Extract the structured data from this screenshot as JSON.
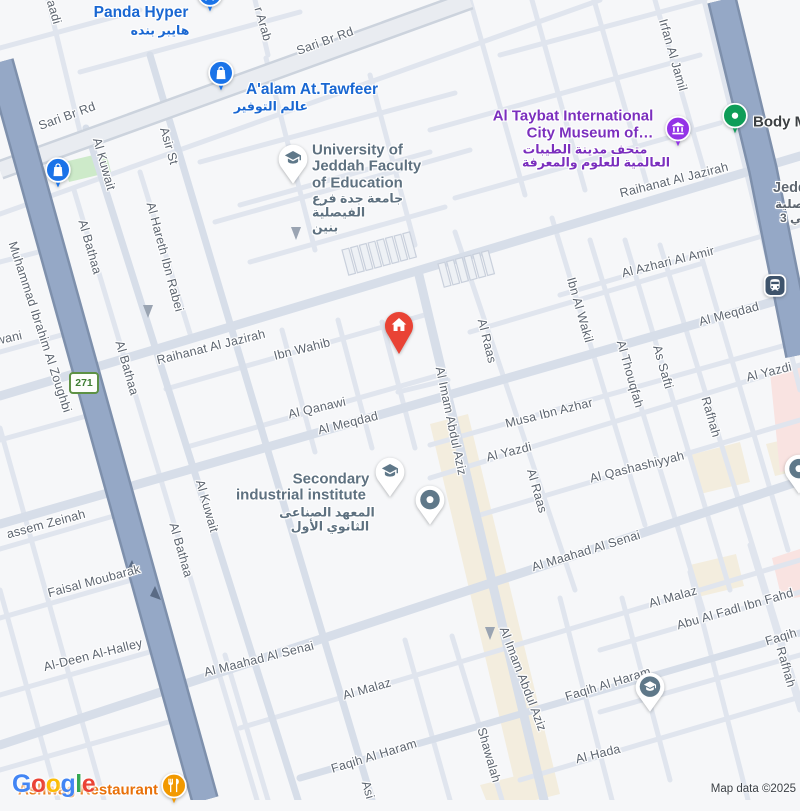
{
  "map_colors": {
    "background": "#f6f7f9",
    "road_minor": "#e0e5ee",
    "road_major": "#d7dee9",
    "sari_fill": "#e9ecf1",
    "sari_casing": "#ccd3dd",
    "highway_fill": "#95a8c6",
    "highway_casing": "#7e90ac",
    "park_green": "#cdeac9",
    "commercial_beige": "#f3edde",
    "hospital_pink": "#f9e3e1",
    "poi_blue": "#1a73e8",
    "poi_blue_text": "#1967d2",
    "poi_purple": "#9334e6",
    "poi_purple_text": "#7b2fbe",
    "poi_green": "#0f9d58",
    "poi_orange": "#f29900",
    "poi_orange_text": "#e8710a",
    "poi_red": "#e94335",
    "poi_slate": "#5f7889",
    "school_text": "#5e7180",
    "transit_navy": "#3e536b"
  },
  "road_labels": [
    {
      "text": "Sari Br Rd",
      "x": 67,
      "y": 116,
      "rot": -20
    },
    {
      "text": "Sari Br Rd",
      "x": 325,
      "y": 41,
      "rot": -20
    },
    {
      "text": "Raihanat Al Jazirah",
      "x": 674,
      "y": 180,
      "rot": -14
    },
    {
      "text": "Raihanat Al Jazirah",
      "x": 211,
      "y": 347,
      "rot": -14
    },
    {
      "text": "Ibn Wahib",
      "x": 302,
      "y": 349,
      "rot": -14
    },
    {
      "text": "Al Qanawi",
      "x": 317,
      "y": 408,
      "rot": -13
    },
    {
      "text": "Al Meqdad",
      "x": 348,
      "y": 423,
      "rot": -14
    },
    {
      "text": "Al Meqdad",
      "x": 729,
      "y": 314,
      "rot": -15
    },
    {
      "text": "Musa Ibn Azhar",
      "x": 549,
      "y": 413,
      "rot": -14
    },
    {
      "text": "Al Yazdi",
      "x": 509,
      "y": 452,
      "rot": -14
    },
    {
      "text": "Al Yazdi",
      "x": 769,
      "y": 372,
      "rot": -14
    },
    {
      "text": "Al Qashashiyyah",
      "x": 637,
      "y": 467,
      "rot": -14
    },
    {
      "text": "Al Azhari Al Amir",
      "x": 668,
      "y": 262,
      "rot": -14
    },
    {
      "text": "Al Maahad Al Senai",
      "x": 586,
      "y": 551,
      "rot": -17
    },
    {
      "text": "Al Maahad Al Senai",
      "x": 259,
      "y": 659,
      "rot": -14
    },
    {
      "text": "Al Malaz",
      "x": 367,
      "y": 689,
      "rot": -16
    },
    {
      "text": "Al Malaz",
      "x": 673,
      "y": 597,
      "rot": -16
    },
    {
      "text": "Faqih Al Haram",
      "x": 374,
      "y": 756,
      "rot": -17
    },
    {
      "text": "Faqih Al Haram",
      "x": 608,
      "y": 684,
      "rot": -17
    },
    {
      "text": "Faqih",
      "x": 781,
      "y": 637,
      "rot": -17
    },
    {
      "text": "Al Hada",
      "x": 598,
      "y": 754,
      "rot": -14
    },
    {
      "text": "Abu Al Fadl Ibn Fahd",
      "x": 735,
      "y": 609,
      "rot": -16
    },
    {
      "text": "Faisal Moubarak",
      "x": 94,
      "y": 581,
      "rot": -15
    },
    {
      "text": "assem Zeinah",
      "x": 46,
      "y": 524,
      "rot": -15
    },
    {
      "text": "Al-Deen Al-Halley",
      "x": 93,
      "y": 655,
      "rot": -14
    },
    {
      "text": "wani",
      "x": 9,
      "y": 338,
      "rot": -13
    },
    {
      "text": "Al Kuwait",
      "x": 104,
      "y": 164,
      "rot": 74
    },
    {
      "text": "Al Kuwait",
      "x": 207,
      "y": 506,
      "rot": 74
    },
    {
      "text": "Asir St",
      "x": 169,
      "y": 146,
      "rot": 74
    },
    {
      "text": "Asi",
      "x": 368,
      "y": 790,
      "rot": 74
    },
    {
      "text": "Al Bathaa",
      "x": 90,
      "y": 247,
      "rot": 74
    },
    {
      "text": "Al Bathaa",
      "x": 127,
      "y": 368,
      "rot": 74
    },
    {
      "text": "Al Bathaa",
      "x": 181,
      "y": 550,
      "rot": 74
    },
    {
      "text": "Al Hareth Ibn Rabei",
      "x": 165,
      "y": 257,
      "rot": 75
    },
    {
      "text": "Muhammad Ibrahim Al Zoughbi",
      "x": 40,
      "y": 327,
      "rot": 72
    },
    {
      "text": "Al Imam Abdul Aziz",
      "x": 451,
      "y": 421,
      "rot": 78
    },
    {
      "text": "Al Imam Abdul Aziz",
      "x": 523,
      "y": 679,
      "rot": 69
    },
    {
      "text": "Al Raas",
      "x": 487,
      "y": 341,
      "rot": 76
    },
    {
      "text": "Al Raas",
      "x": 537,
      "y": 491,
      "rot": 74
    },
    {
      "text": "Ibn Al Wakil",
      "x": 580,
      "y": 310,
      "rot": 74
    },
    {
      "text": "Al Thouqfah",
      "x": 630,
      "y": 374,
      "rot": 74
    },
    {
      "text": "As Safti",
      "x": 663,
      "y": 367,
      "rot": 74
    },
    {
      "text": "Rafhah",
      "x": 711,
      "y": 417,
      "rot": 74
    },
    {
      "text": "Rafhah",
      "x": 786,
      "y": 667,
      "rot": 74
    },
    {
      "text": "Irfan Al Jamil",
      "x": 673,
      "y": 55,
      "rot": 74
    },
    {
      "text": "r Arab",
      "x": 263,
      "y": 24,
      "rot": 74
    },
    {
      "text": "Shawalah",
      "x": 489,
      "y": 755,
      "rot": 74
    },
    {
      "text": "aadi",
      "x": 54,
      "y": 12,
      "rot": 74
    }
  ],
  "poi_labels": [
    {
      "text": "Panda Hyper",
      "x": 141,
      "y": 13,
      "color": "#1967d2",
      "size": 15.5
    },
    {
      "text": "هايبر بنده",
      "x": 160,
      "y": 30,
      "color": "#1967d2",
      "size": 12.5
    },
    {
      "text": "A'alam At.Tawfeer",
      "x": 312,
      "y": 90,
      "color": "#1967d2",
      "size": 15.5
    },
    {
      "text": "عالم التوفير",
      "x": 271,
      "y": 106,
      "color": "#1967d2",
      "size": 12.5
    },
    {
      "text": "University of",
      "x": 312,
      "y": 150,
      "color": "#5e7180",
      "size": 15,
      "align": "l"
    },
    {
      "text": "Jeddah Faculty",
      "x": 312,
      "y": 166,
      "color": "#5e7180",
      "size": 15,
      "align": "l"
    },
    {
      "text": "of Education",
      "x": 312,
      "y": 183,
      "color": "#5e7180",
      "size": 15,
      "align": "l"
    },
    {
      "text": "جامعة جدة فرع",
      "x": 312,
      "y": 198,
      "color": "#5e7180",
      "size": 12.5,
      "align": "l"
    },
    {
      "text": "الفيصلية",
      "x": 312,
      "y": 212,
      "color": "#5e7180",
      "size": 12.5,
      "align": "l"
    },
    {
      "text": "بنين",
      "x": 312,
      "y": 227,
      "color": "#5e7180",
      "size": 12.5,
      "align": "l"
    },
    {
      "text": "Al Taybat International",
      "x": 573,
      "y": 116,
      "color": "#7b2fbe",
      "size": 15
    },
    {
      "text": "City Museum of…",
      "x": 590,
      "y": 133,
      "color": "#7b2fbe",
      "size": 15
    },
    {
      "text": "متحف مدينة الطيبات",
      "x": 585,
      "y": 149,
      "color": "#7b2fbe",
      "size": 12.5
    },
    {
      "text": "العالمية للعلوم والمعرفة",
      "x": 596,
      "y": 162,
      "color": "#7b2fbe",
      "size": 12.5
    },
    {
      "text": "Body M",
      "x": 753,
      "y": 122,
      "color": "#3c4043",
      "size": 15,
      "align": "l"
    },
    {
      "text": "Secondary",
      "x": 331,
      "y": 479,
      "color": "#5e7180",
      "size": 15
    },
    {
      "text": "industrial institute",
      "x": 301,
      "y": 495,
      "color": "#5e7180",
      "size": 15
    },
    {
      "text": "المعهد الصناعى",
      "x": 327,
      "y": 512,
      "color": "#5e7180",
      "size": 12.5
    },
    {
      "text": "الثانوي الأول",
      "x": 330,
      "y": 526,
      "color": "#5e7180",
      "size": 12.5
    },
    {
      "text": "Ashwag Restaurant",
      "x": 88,
      "y": 790,
      "color": "#e8710a",
      "size": 15
    },
    {
      "text": "Jedda",
      "x": 773,
      "y": 188,
      "color": "#5f6771",
      "size": 14.5,
      "align": "l"
    },
    {
      "text": "الفيصلية",
      "x": 775,
      "y": 204,
      "color": "#5f6771",
      "size": 12,
      "align": "l"
    },
    {
      "text": "حي 3",
      "x": 780,
      "y": 218,
      "color": "#5f6771",
      "size": 12,
      "align": "l"
    }
  ],
  "poi_icons": [
    {
      "icon": "shopping-cart",
      "x": 210,
      "y": 17,
      "bg": "#1a73e8"
    },
    {
      "icon": "shopping-bag",
      "x": 221,
      "y": 96,
      "bg": "#1a73e8"
    },
    {
      "icon": "shopping-bag",
      "x": 58,
      "y": 193,
      "bg": "#1a73e8"
    },
    {
      "icon": "museum",
      "x": 678,
      "y": 135,
      "bg": "#9334e6"
    },
    {
      "icon": "fitness-dot",
      "x": 735,
      "y": 122,
      "bg": "#0f9d58"
    },
    {
      "icon": "restaurant",
      "x": 174,
      "y": 792,
      "bg": "#f29900"
    },
    {
      "icon": "graduation-cap-pin",
      "x": 293,
      "y": 187
    },
    {
      "icon": "graduation-cap-pin",
      "x": 390,
      "y": 500
    },
    {
      "icon": "dot-pin",
      "x": 430,
      "y": 528
    },
    {
      "icon": "dot-pin",
      "x": 799,
      "y": 497
    },
    {
      "icon": "graduation-cap-pin-dark",
      "x": 650,
      "y": 715
    },
    {
      "icon": "transit",
      "x": 775,
      "y": 288
    },
    {
      "icon": "house-pin",
      "x": 399,
      "y": 357,
      "bg": "#e94335"
    }
  ],
  "route_shield": {
    "text": "271",
    "x": 84,
    "y": 383
  },
  "attribution": {
    "logo_letters": [
      {
        "ch": "G",
        "color": "#4285F4"
      },
      {
        "ch": "o",
        "color": "#EA4335"
      },
      {
        "ch": "o",
        "color": "#FBBC05"
      },
      {
        "ch": "g",
        "color": "#4285F4"
      },
      {
        "ch": "l",
        "color": "#34A853"
      },
      {
        "ch": "e",
        "color": "#EA4335"
      }
    ],
    "map_data": "Map data ©2025"
  }
}
